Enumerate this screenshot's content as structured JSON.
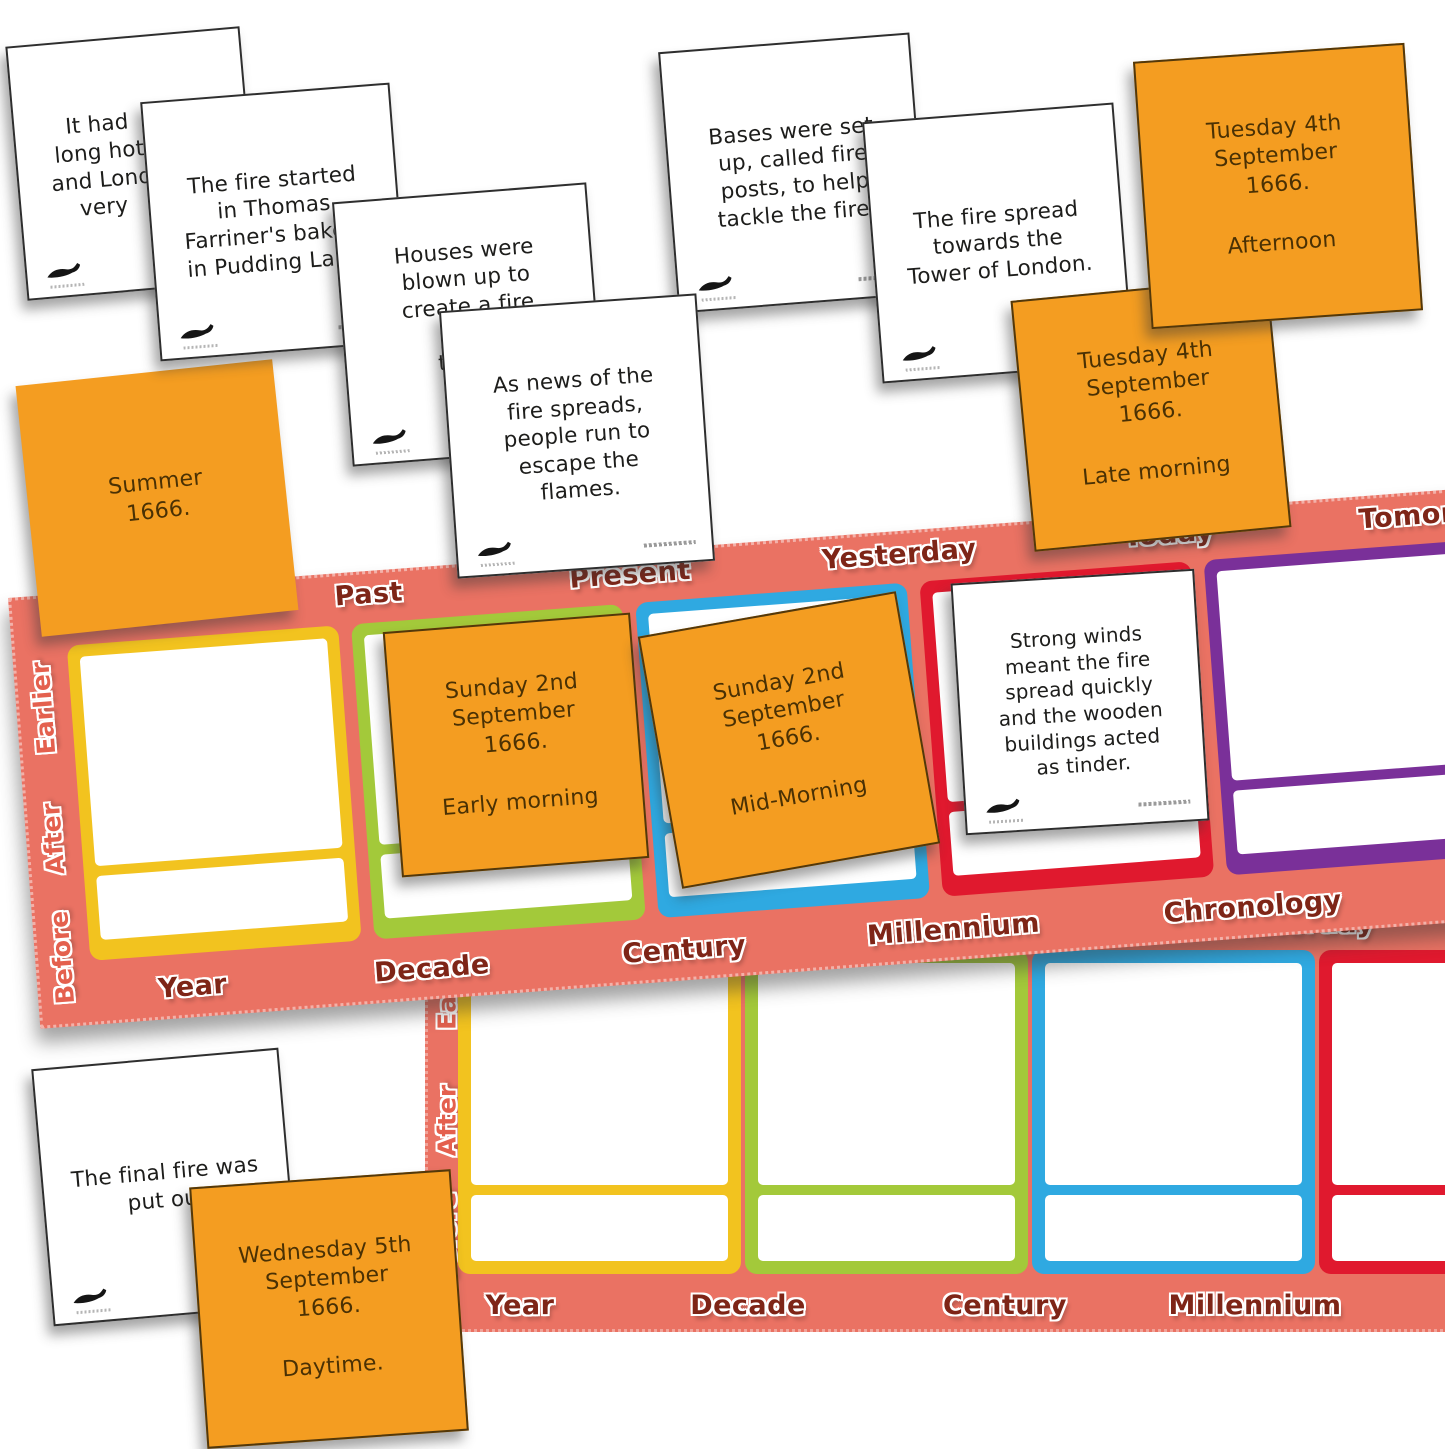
{
  "colors": {
    "board_background": "#EA7263",
    "orange_card": "#F49D21",
    "frame_yellow": "#F2C31F",
    "frame_green": "#A3C93A",
    "frame_blue": "#2FA9E1",
    "frame_red": "#E0192E",
    "frame_purple": "#7A3099",
    "board_label_text": "#7E2517",
    "board_side_label_text": "#E4604E",
    "event_card_text": "#1d1d1b",
    "date_card_text": "#4a3104"
  },
  "board1": {
    "top_labels": [
      "Later",
      "Past",
      "Present",
      "Yesterday",
      "Today",
      "Tomorrow"
    ],
    "side_labels": [
      "Earlier",
      "After",
      "Before"
    ],
    "bottom_labels": [
      "Year",
      "Decade",
      "Century",
      "Millennium",
      "Chronology",
      "L"
    ]
  },
  "board2": {
    "top_labels": [
      "Yesterday"
    ],
    "side_labels": [
      "Earlier",
      "After",
      "Before"
    ],
    "bottom_labels": [
      "Year",
      "Decade",
      "Century",
      "Millennium"
    ]
  },
  "event_cards": {
    "long_hot_summer_fragment": "It had\nlong hot\nand Lond\nvery",
    "bakery": "The fire started\nin Thomas\nFarriner's bakery\nin Pudding Lane.",
    "houses_blown_up_fragment": "Houses were\nblown up to\ncreate a fire\nbrea\nthe sp",
    "news_spreads": "As news of the\nfire spreads,\npeople run to\nescape the\nflames.",
    "fire_posts": "Bases were set\nup, called fire\nposts, to help\ntackle the fire.",
    "tower_of_london": "The fire spread\ntowards the\nTower of London.",
    "strong_winds": "Strong winds\nmeant the fire\nspread quickly\nand the wooden\nbuildings acted\nas tinder.",
    "final_fire": "The final fire was\nput out"
  },
  "date_cards": {
    "summer": {
      "date": "Summer\n1666.",
      "time": ""
    },
    "tuesday_afternoon": {
      "date": "Tuesday 4th\nSeptember\n1666.",
      "time": "Afternoon"
    },
    "tuesday_late_morning": {
      "date": "Tuesday 4th\nSeptember\n1666.",
      "time": "Late morning"
    },
    "sunday_early_morning": {
      "date": "Sunday 2nd\nSeptember\n1666.",
      "time": "Early morning"
    },
    "sunday_mid_morning": {
      "date": "Sunday 2nd\nSeptember\n1666.",
      "time": "Mid-Morning"
    },
    "wednesday_daytime": {
      "date": "Wednesday 5th\nSeptember\n1666.",
      "time": "Daytime."
    }
  }
}
